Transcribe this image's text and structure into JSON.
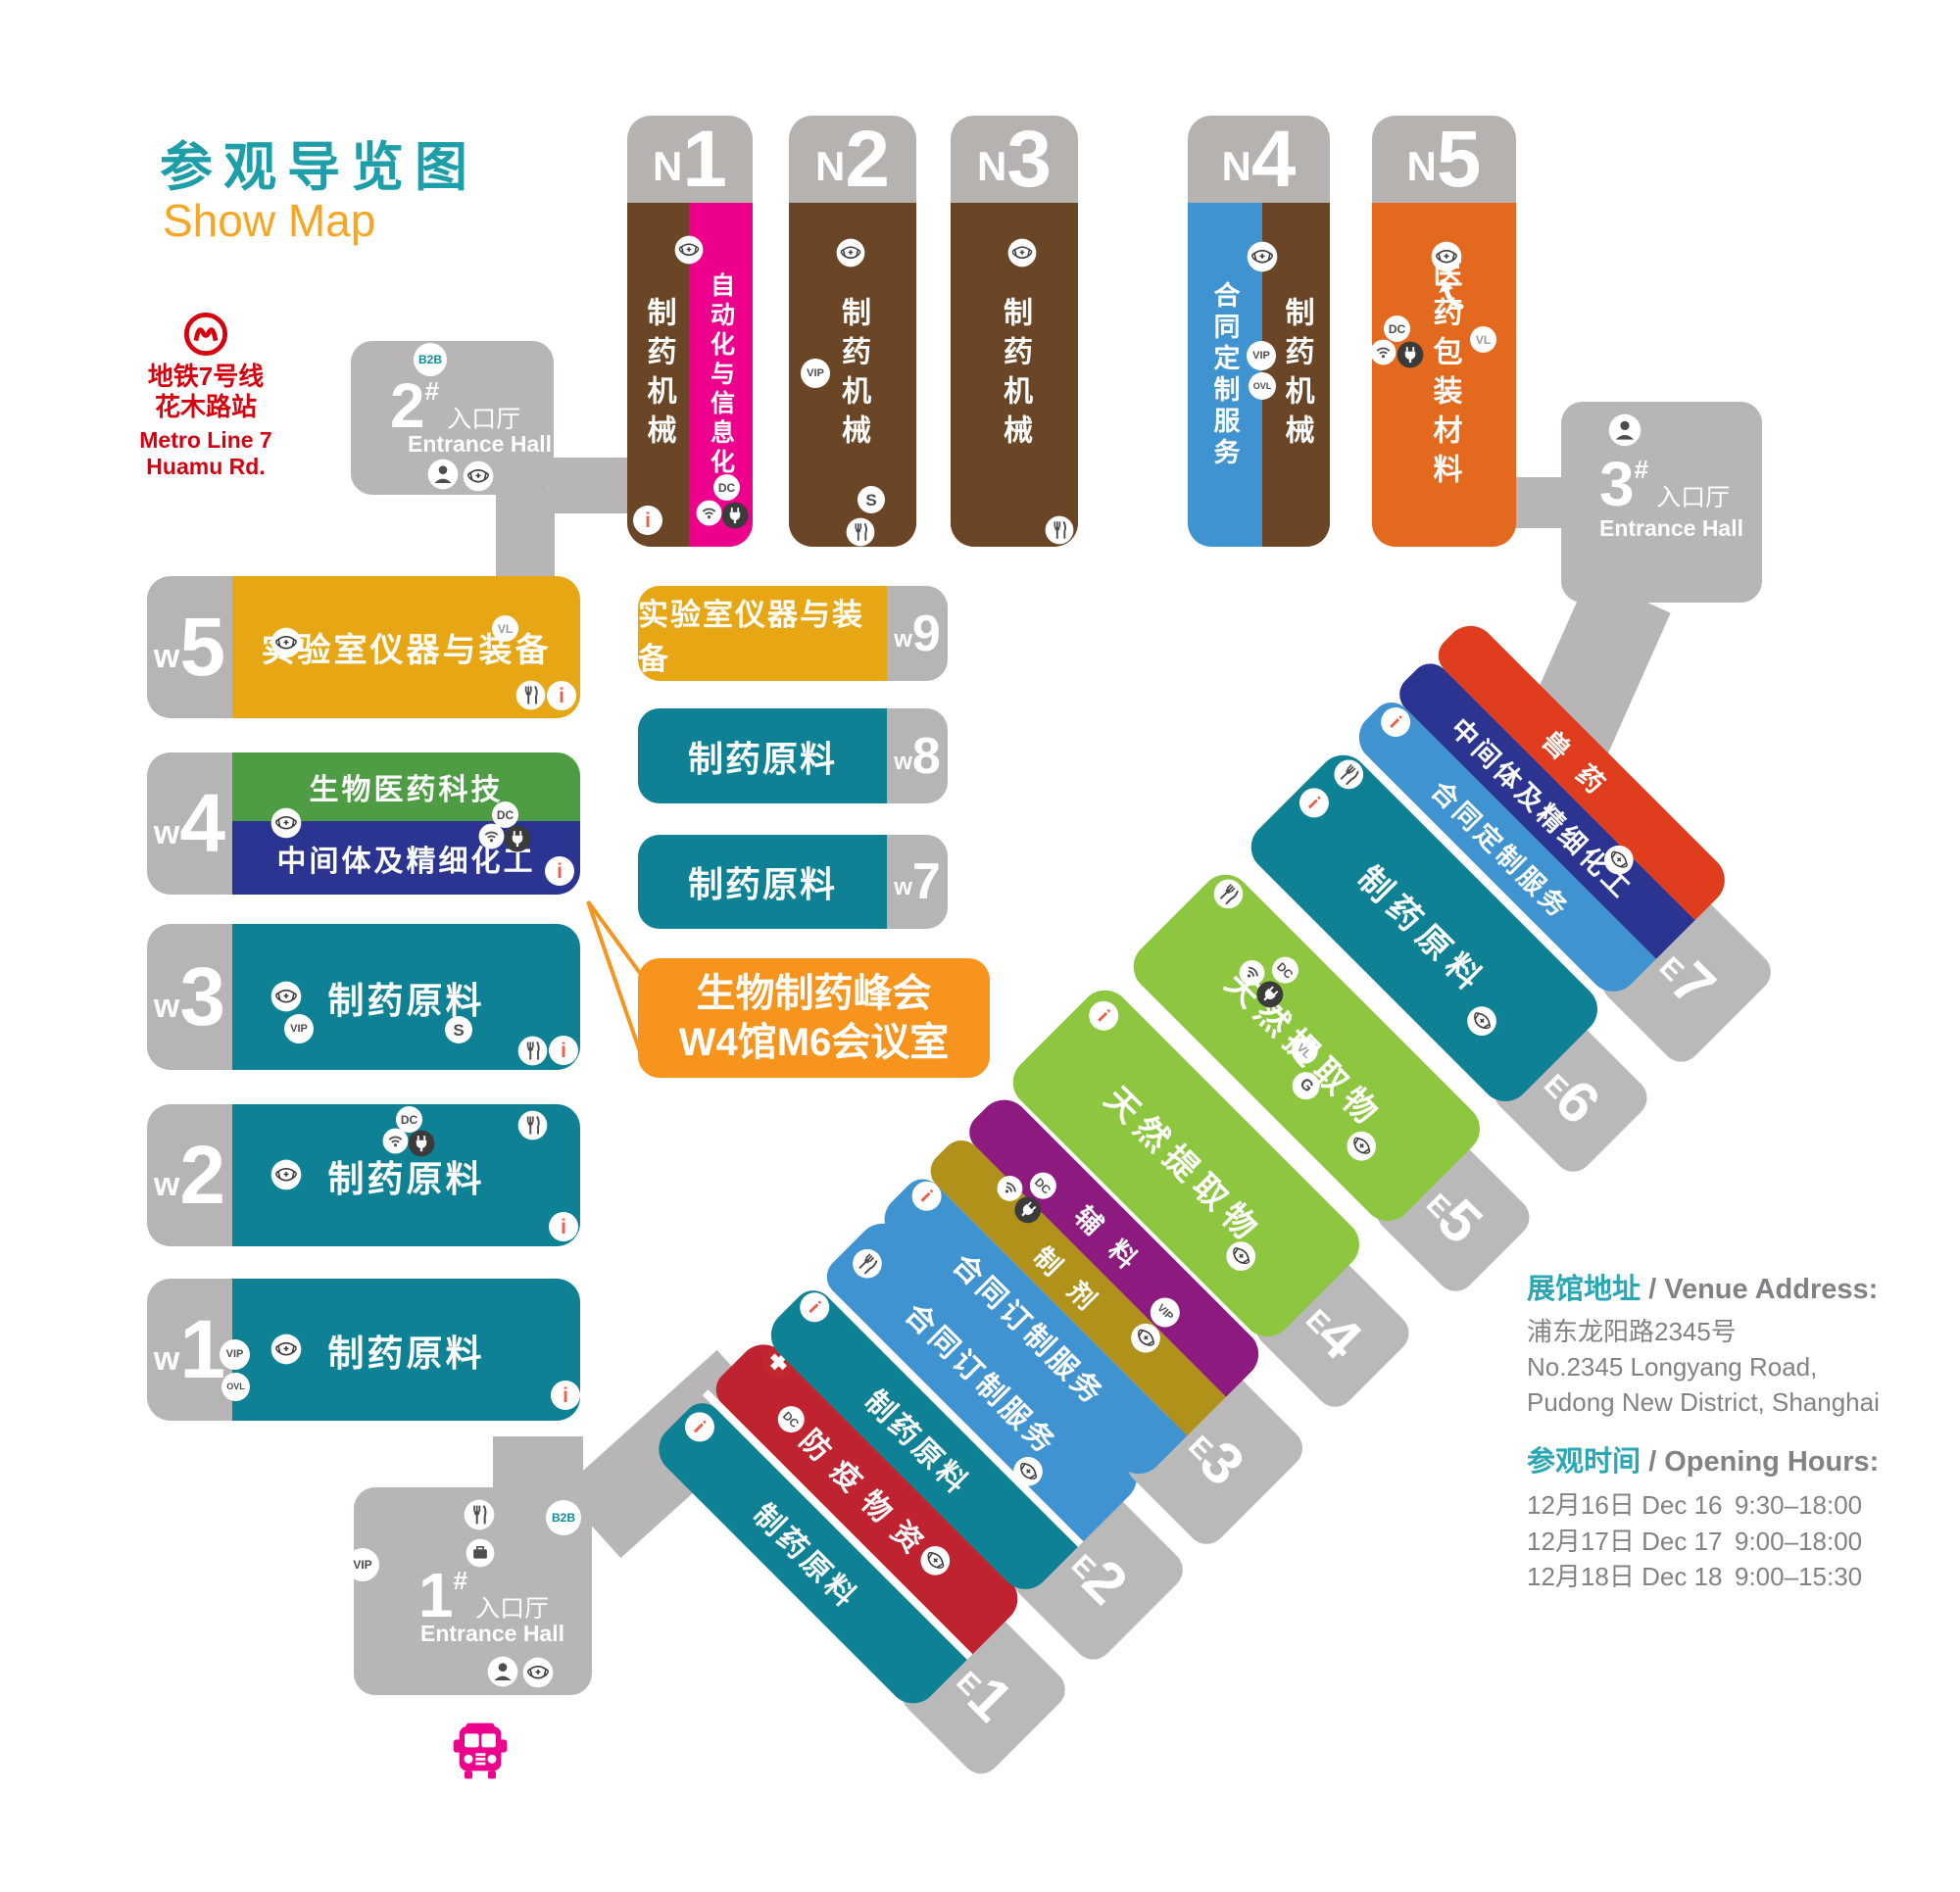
{
  "title": {
    "cn": "参观导览图",
    "en": "Show Map"
  },
  "metro": {
    "line_cn": "地铁7号线",
    "station_cn": "花木路站",
    "line_en": "Metro Line 7",
    "station_en": "Huamu Rd."
  },
  "badges": {
    "b2b": "B2B",
    "vip": "VIP",
    "ovl": "OVL",
    "dc": "DC",
    "vl": "VL",
    "g": "G",
    "s": "S",
    "info": "i"
  },
  "entrances": {
    "hall1": {
      "num": "1",
      "hash": "#",
      "cn": "入口厅",
      "en": "Entrance Hall"
    },
    "hall2": {
      "num": "2",
      "hash": "#",
      "cn": "入口厅",
      "en": "Entrance Hall"
    },
    "hall3": {
      "num": "3",
      "hash": "#",
      "cn": "入口厅",
      "en": "Entrance Hall"
    }
  },
  "halls": {
    "n1": {
      "letter": "N",
      "num": "1",
      "zone1": "制药机械",
      "zone2": "自动化与信息化"
    },
    "n2": {
      "letter": "N",
      "num": "2",
      "zone1": "制药机械"
    },
    "n3": {
      "letter": "N",
      "num": "3",
      "zone1": "制药机械"
    },
    "n4": {
      "letter": "N",
      "num": "4",
      "zone1": "合同定制服务",
      "zone2": "制药机械"
    },
    "n5": {
      "letter": "N",
      "num": "5",
      "zone1": "医药包装材料"
    },
    "w5": {
      "letter": "w",
      "num": "5",
      "zone1": "实验室仪器与装备"
    },
    "w4": {
      "letter": "w",
      "num": "4",
      "zone1": "生物医药科技",
      "zone2": "中间体及精细化工"
    },
    "w3": {
      "letter": "w",
      "num": "3",
      "zone1": "制药原料"
    },
    "w2": {
      "letter": "w",
      "num": "2",
      "zone1": "制药原料"
    },
    "w1": {
      "letter": "w",
      "num": "1",
      "zone1": "制药原料"
    },
    "w9": {
      "letter": "w",
      "num": "9",
      "zone1": "实验室仪器与装备"
    },
    "w8": {
      "letter": "w",
      "num": "8",
      "zone1": "制药原料"
    },
    "w7": {
      "letter": "w",
      "num": "7",
      "zone1": "制药原料"
    },
    "e1": {
      "letter": "E",
      "num": "1",
      "zone1": "防疫物资",
      "zone2": "制药原料"
    },
    "e2": {
      "letter": "E",
      "num": "2",
      "zone1": "合同订制服务",
      "zone2": "制药原料"
    },
    "e3": {
      "letter": "E",
      "num": "3",
      "zone1": "辅料",
      "zone2": "制剂",
      "zone3": "合同订制服务"
    },
    "e4": {
      "letter": "E",
      "num": "4",
      "zone1": "天然提取物"
    },
    "e5": {
      "letter": "E",
      "num": "5",
      "zone1": "天然提取物"
    },
    "e6": {
      "letter": "E",
      "num": "6",
      "zone1": "制药原料"
    },
    "e7": {
      "letter": "E",
      "num": "7",
      "zone1": "兽药",
      "zone2": "中间体及精细化工",
      "zone3": "合同定制服务"
    }
  },
  "callout": {
    "line1": "生物制药峰会",
    "line2": "W4馆M6会议室"
  },
  "address": {
    "label_cn": "展馆地址",
    "sep": "/",
    "label_en": "Venue Address:",
    "line1": "浦东龙阳路2345号",
    "line2": "No.2345 Longyang Road,",
    "line3": "Pudong New District, Shanghai"
  },
  "hours": {
    "label_cn": "参观时间",
    "sep": "/",
    "label_en": "Opening Hours:",
    "row1": {
      "date_cn": "12月16日",
      "date_en": "Dec 16",
      "time": "9:30–18:00"
    },
    "row2": {
      "date_cn": "12月17日",
      "date_en": "Dec 17",
      "time": "9:00–18:00"
    },
    "row3": {
      "date_cn": "12月18日",
      "date_en": "Dec 18",
      "time": "9:00–15:30"
    }
  },
  "colors": {
    "teal": "#0e8194",
    "brown": "#6b4626",
    "magenta": "#ec008c",
    "blue": "#3f93d0",
    "orange": "#e2691d",
    "yellow": "#e7a614",
    "green": "#4e9d45",
    "navy": "#2b3490",
    "lime": "#8dc63f",
    "purple": "#8c1a7f",
    "olive": "#b0921b",
    "red": "#bf2330",
    "red_orange": "#e03c1e",
    "callout_orange": "#f7941d",
    "gray": "#b7b5b5",
    "title_teal": "#1e9ea8",
    "title_orange": "#f5a623",
    "metro_red": "#d7000f",
    "bus_pink": "#ec008c",
    "info_red": "#e8604c"
  }
}
